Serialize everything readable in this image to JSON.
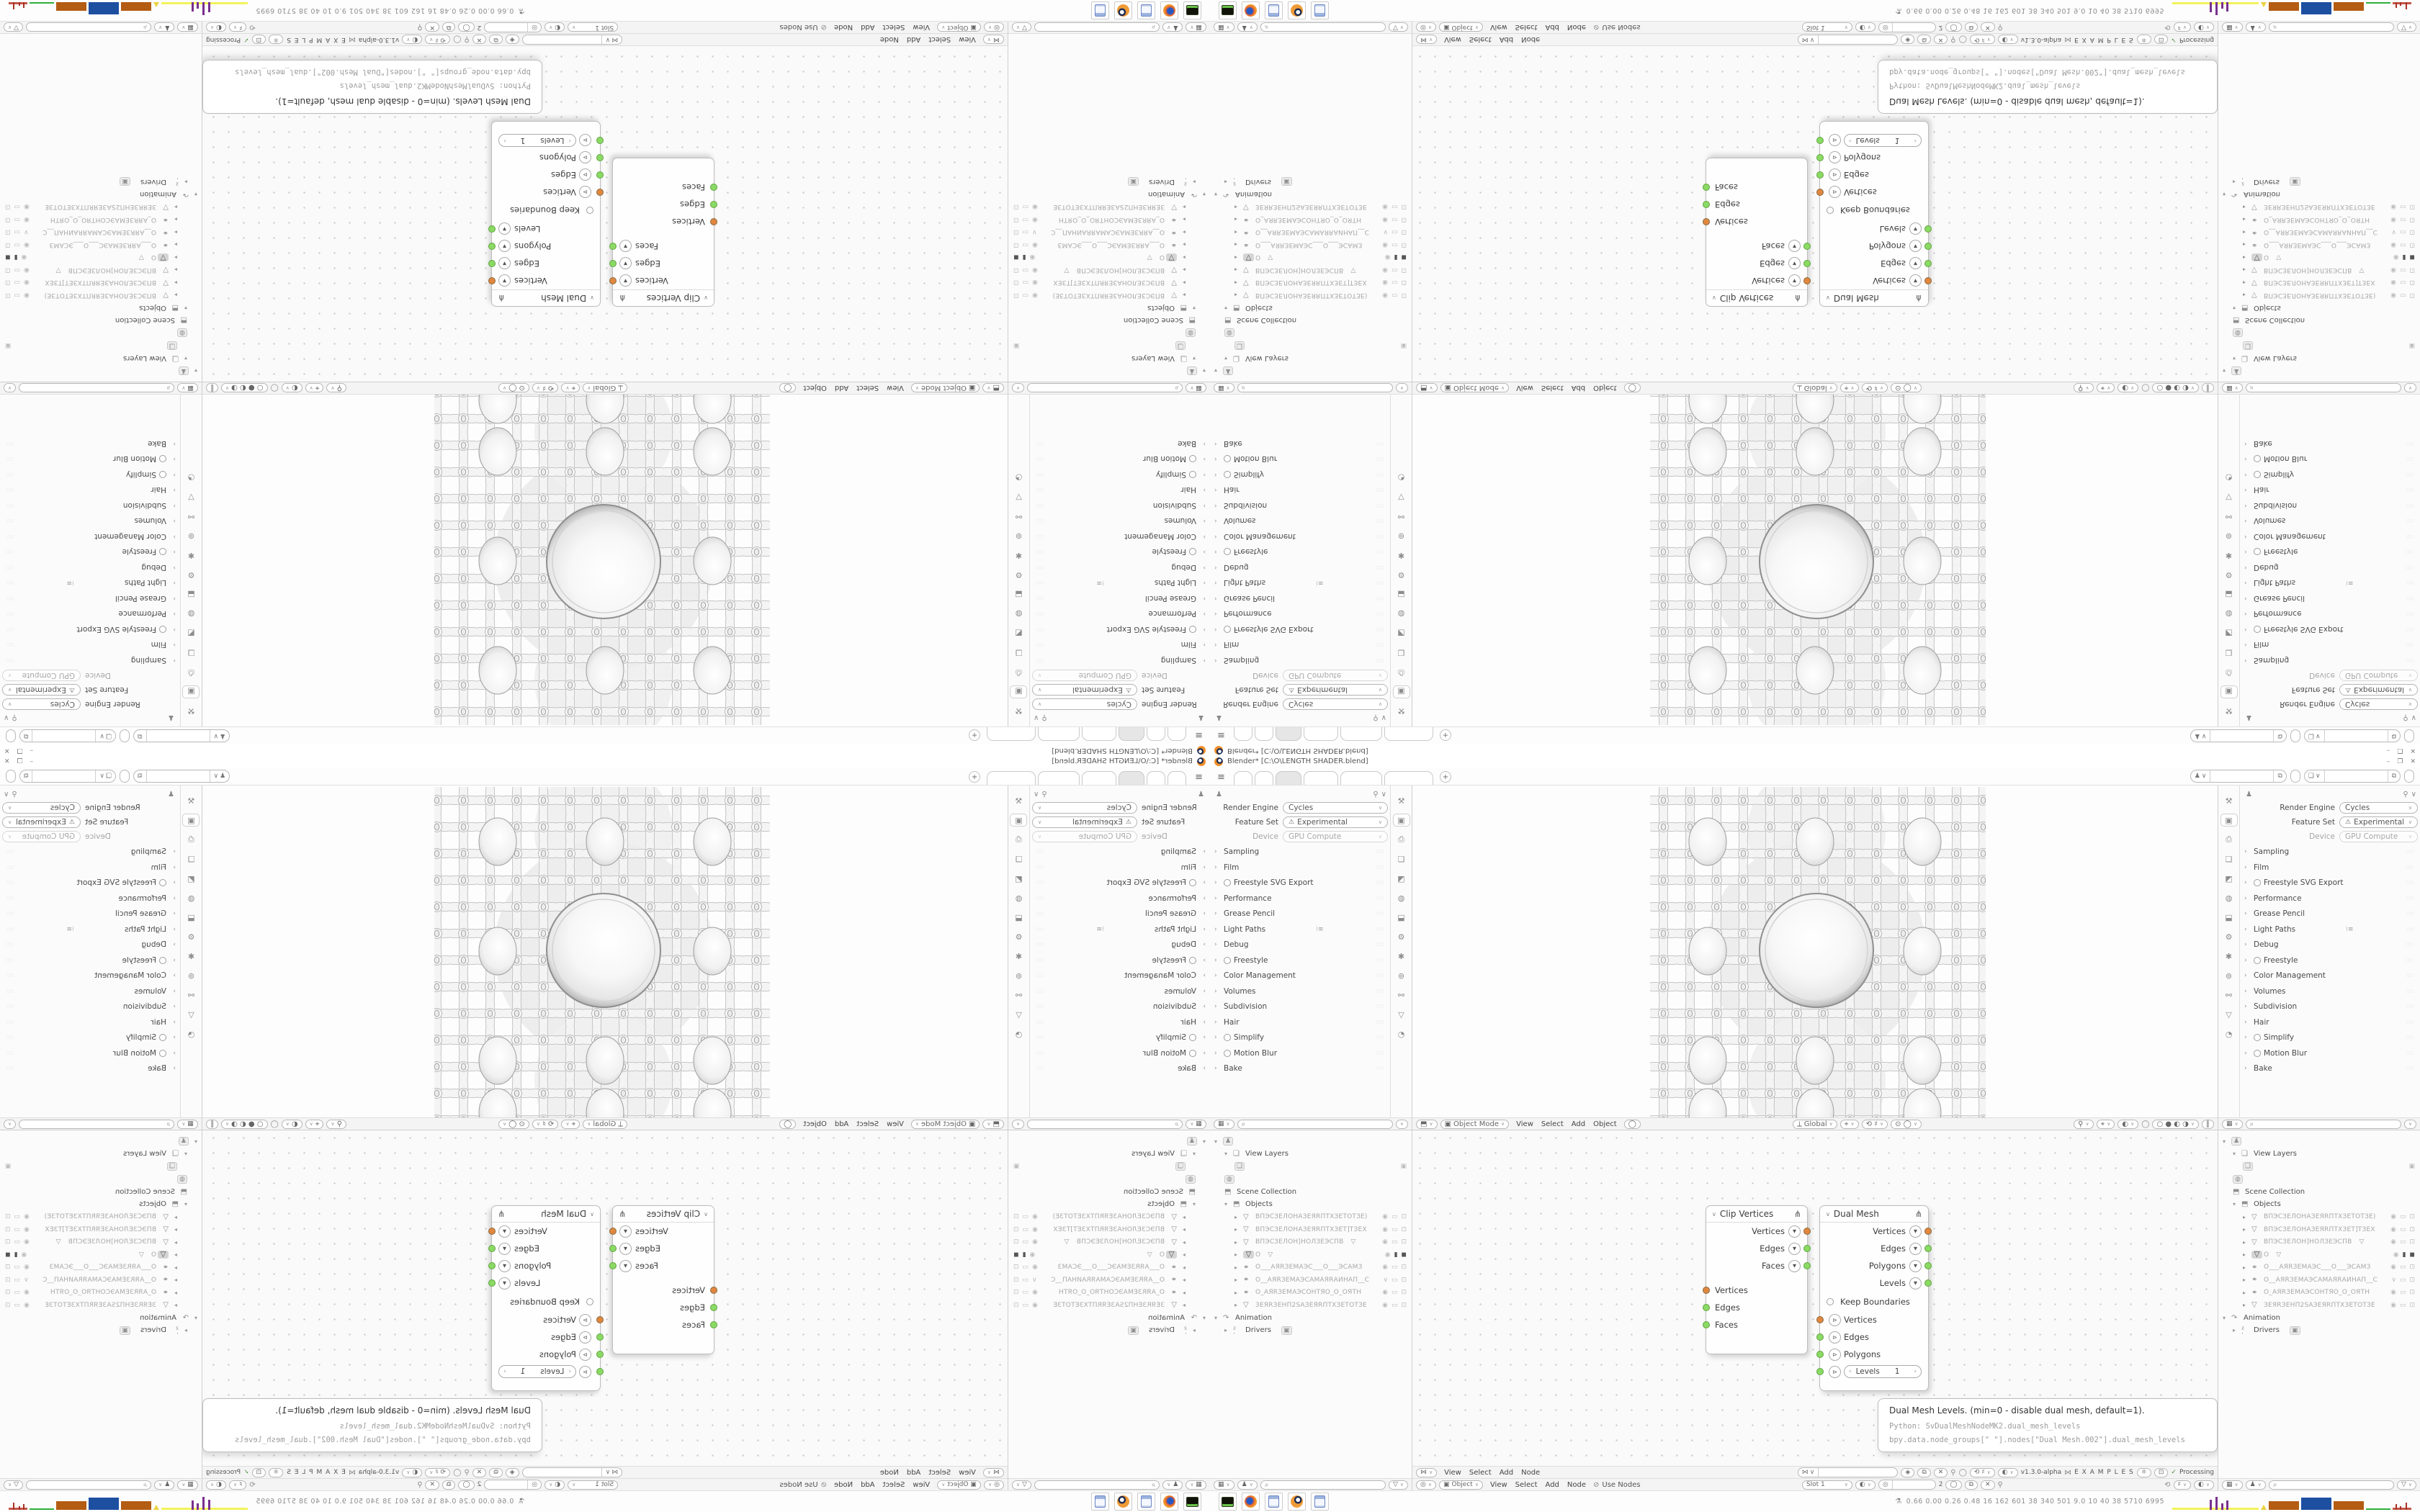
{
  "window": {
    "title": "Blender* [C:\\O\\LENGTH SHADER.blend]",
    "minimize": "–",
    "maximize": "❐",
    "close": "✕"
  },
  "topbar": {
    "new_tab": "+"
  },
  "properties": {
    "render_engine_label": "Render Engine",
    "render_engine": "Cycles",
    "feature_set_label": "Feature Set",
    "feature_set": "Experimental",
    "device_label": "Device",
    "device": "GPU Compute",
    "sections": [
      "Sampling",
      "Film",
      "Freestyle SVG Export",
      "Performance",
      "Grease Pencil",
      "Light Paths",
      "Debug",
      "Freestyle",
      "Color Management",
      "Volumes",
      "Subdivision",
      "Hair",
      "Simplify",
      "Motion Blur",
      "Bake"
    ]
  },
  "viewport": {
    "mode": "Object Mode",
    "menu_view": "View",
    "menu_select": "Select",
    "menu_add": "Add",
    "menu_object": "Object",
    "orientation": "Global"
  },
  "outliner": {
    "view_layers": "View Layers",
    "scene_collection": "Scene Collection",
    "objects": "Objects",
    "animation": "Animation",
    "drivers": "Drivers",
    "rows": [
      {
        "name": "ВПЭСЗЕЛОНАЗЕЯRПТХЗЕТОТЗЕ)"
      },
      {
        "name": "ВПЭСЗЕЛОНАЗЕЯRПТХЗЕТ]ТЗЕХ"
      },
      {
        "name": "ВПЭСЗЕЛОН]НОЛЗЕЭСПВ"
      },
      {
        "name": "O"
      },
      {
        "name": "O___АЯRЗЕМАЭС___O___ЭСАМЗ"
      },
      {
        "name": "O__АЯRЗЕМАЭСАМАЯRАИНАП__С"
      },
      {
        "name": "O_АЯRЗЕМАЭСОНТЯО_О_ОЯТН"
      },
      {
        "name": "ЗЕЯRЗЕНП2SАЗЕЯRПТХЗЕТОТЗЕ"
      }
    ]
  },
  "sverchok": {
    "menu_view": "View",
    "menu_select": "Select",
    "menu_add": "Add",
    "menu_node": "Node",
    "version": "v1.3.0-alpha",
    "examples": "E X A M P L E S",
    "processing": "Processing"
  },
  "shader": {
    "type": "Object",
    "menu_view": "View",
    "menu_select": "Select",
    "menu_add": "Add",
    "menu_node": "Node",
    "use_nodes": "Use Nodes",
    "slot": "Slot 1",
    "index": "2"
  },
  "nodes": {
    "clip_vertices": {
      "title": "Clip Vertices",
      "out_vertices": "Vertices",
      "out_edges": "Edges",
      "out_faces": "Faces",
      "in_vertices": "Vertices",
      "in_edges": "Edges",
      "in_faces": "Faces"
    },
    "dual_mesh": {
      "title": "Dual Mesh",
      "out_vertices": "Vertices",
      "out_edges": "Edges",
      "out_polygons": "Polygons",
      "out_levels": "Levels",
      "keep_boundaries": "Keep Boundaries",
      "in_vertices": "Vertices",
      "in_edges": "Edges",
      "in_polygons": "Polygons",
      "levels_label": "Levels",
      "levels_value": "1"
    }
  },
  "tooltip": {
    "line1": "Dual Mesh Levels. (min=0 - disable dual mesh, default=1).",
    "line2": "Python: SvDualMeshNodeMK2.dual_mesh_levels",
    "line3": "bpy.data.node_groups[\" \"].nodes[\"Dual Mesh.002\"].dual_mesh_levels"
  },
  "taskbar": {
    "stats": "0.66 0.00 0.26 0.48   16   162   601   38   340   501   9.0   10   40   38   5710 6995"
  },
  "colors": {
    "socket_orange": "#e0873f",
    "socket_green": "#8ada64",
    "blender_orange": "#ef8f2c"
  }
}
